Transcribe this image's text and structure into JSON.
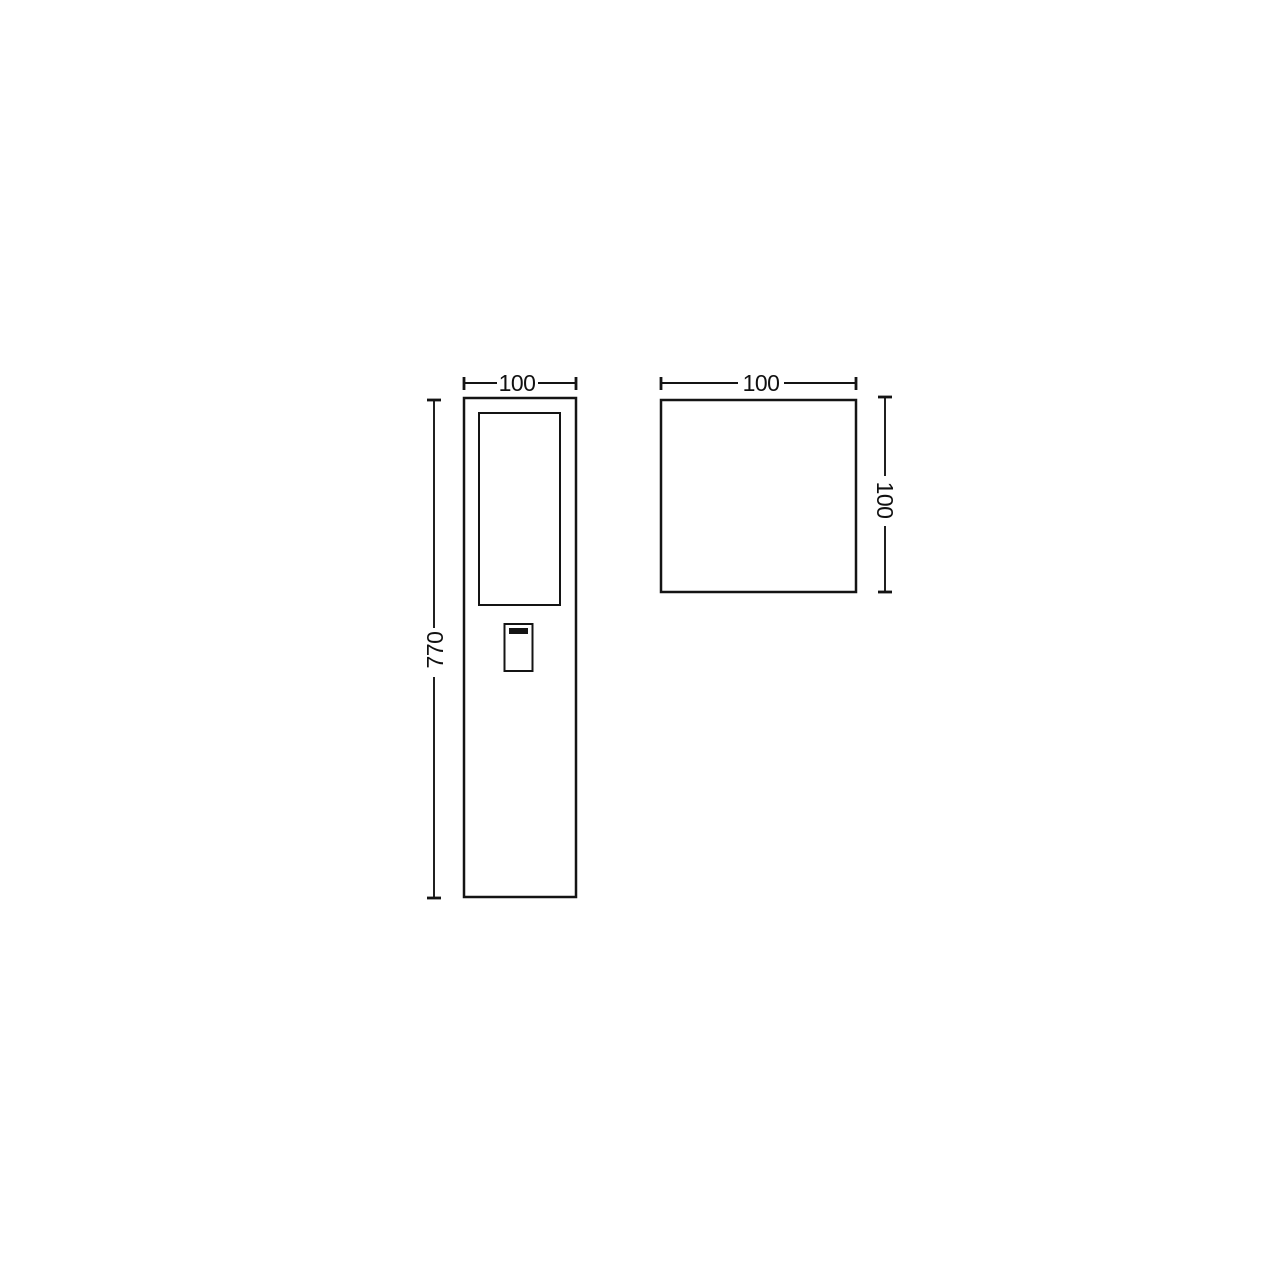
{
  "drawing": {
    "front_view": {
      "width_label": "100",
      "height_label": "770"
    },
    "top_view": {
      "width_label": "100",
      "height_label": "100"
    },
    "colors": {
      "line": "#141414",
      "background": "#ffffff"
    }
  }
}
